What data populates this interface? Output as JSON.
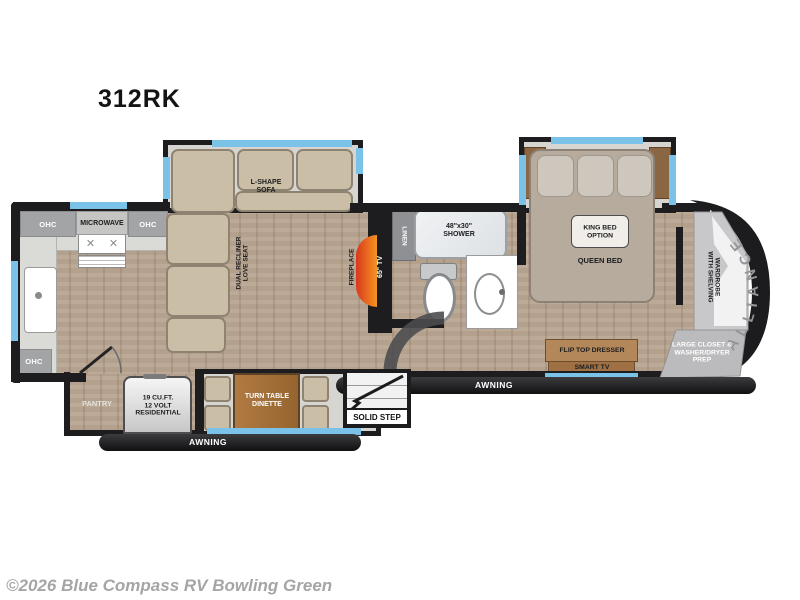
{
  "title": "312RK",
  "watermark": "©2026 Blue Compass RV Bowling Green",
  "brand": "ALLIANCE",
  "colors": {
    "wall": "#1d1d1f",
    "window_blue": "#7ac2e8",
    "wood_floor": "#b9a692",
    "fireplace_orange": "#f08a1d",
    "furniture_beige": "#cabea6",
    "watermark_gray": "#a5a5a5"
  },
  "kitchen": {
    "ohc_top_left": "OHC",
    "microwave": "MICROWAVE",
    "ohc_top_right": "OHC",
    "ohc_side": "OHC",
    "ohc_bottom": "OHC",
    "pantry": "PANTRY",
    "refrigerator": "19 CU.FT.\n12 VOLT\nRESIDENTIAL"
  },
  "living": {
    "sofa": "L-SHAPE\nSOFA",
    "loveseat": "DUAL RECLINER\nLOVE SEAT",
    "fireplace": "FIREPLACE",
    "tv": "65\" TV",
    "dinette": "TURN TABLE\nDINETTE"
  },
  "bathroom": {
    "linen": "LINEN",
    "shower": "48\"x30\"\nSHOWER"
  },
  "bedroom": {
    "king_option": "KING BED\nOPTION",
    "queen": "QUEEN BED",
    "dresser": "FLIP TOP DRESSER",
    "smart_tv": "SMART TV",
    "wardrobe": "WARDROBE\nWITH SHELVING",
    "closet": "LARGE CLOSET &\nWASHER/DRYER\nPREP"
  },
  "exterior": {
    "awning_left": "AWNING",
    "awning_right": "AWNING",
    "solid_step": "SOLID STEP"
  }
}
